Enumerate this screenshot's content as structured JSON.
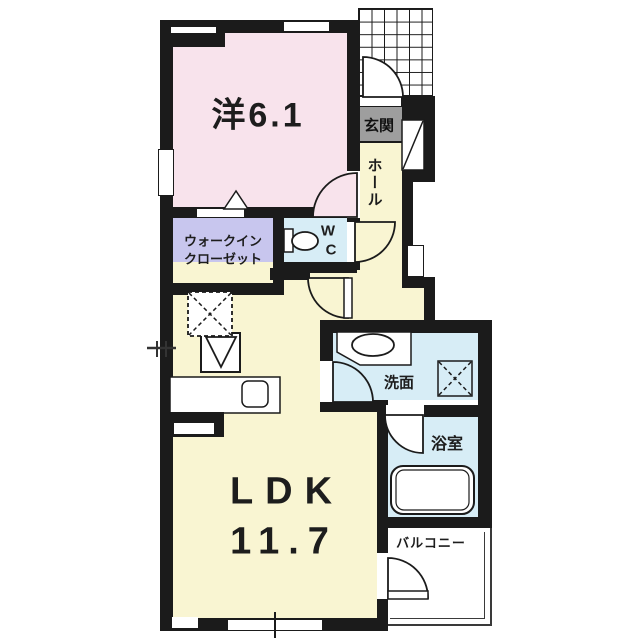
{
  "rooms": {
    "bedroom": {
      "label": "洋6.1"
    },
    "walk_in_closet": {
      "line1": "ウォークイン",
      "line2": "クローゼット"
    },
    "wc": {
      "line1": "W",
      "line2": "C"
    },
    "hall": {
      "label": "ホール"
    },
    "entrance": {
      "label": "玄関"
    },
    "ldk": {
      "name": "LDK",
      "size": "11.7"
    },
    "washroom": {
      "label": "洗面"
    },
    "bathroom": {
      "label": "浴室"
    },
    "balcony": {
      "label": "バルコニー"
    }
  },
  "colors": {
    "bedroom_floor": "#f8e3ec",
    "ldk_floor": "#f9f5d2",
    "closet_floor": "#c8c6ee",
    "wet_area_floor": "#d7edf6",
    "entrance_mat": "#9e9e9e",
    "wall": "#1b1b1b"
  }
}
